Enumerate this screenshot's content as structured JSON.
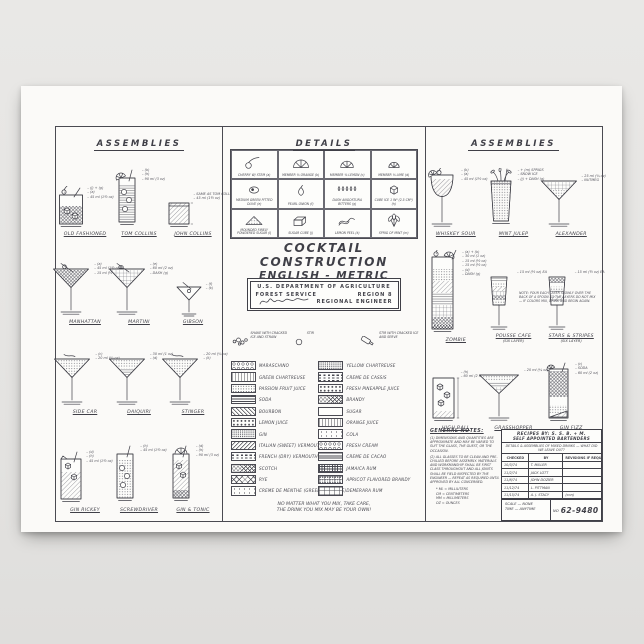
{
  "colors": {
    "page_background": "#e6e5e3",
    "paper": "#fbfaf8",
    "ink": "#3f3f47"
  },
  "sheet": {
    "left_panel": {
      "title": "ASSEMBLIES",
      "rows": [
        {
          "drinks": [
            {
              "name": "OLD FASHIONED",
              "glass": "rocks",
              "annotations": [
                "(j) + (g)",
                "(a)",
                "45 ml (1½ oz)"
              ]
            },
            {
              "name": "TOM COLLINS",
              "glass": "collins",
              "annotations": [
                "(b)",
                "(h)",
                "90 ml (3 oz)"
              ]
            },
            {
              "name": "JOHN COLLINS",
              "glass": "rocks_sq",
              "annotations": [
                "SAME AS TOM COLLINS",
                "45 ml (1½ oz)"
              ]
            }
          ]
        },
        {
          "drinks": [
            {
              "name": "MANHATTAN",
              "glass": "martini_cherry",
              "annotations": [
                "(a)",
                "45 ml (1½ oz)",
                "15 ml (½ oz)"
              ]
            },
            {
              "name": "MARTINI",
              "glass": "martini_olive",
              "annotations": [
                "(e)",
                "60 ml (2 oz)",
                "DASH (g)"
              ]
            },
            {
              "name": "GIBSON",
              "glass": "martini_sm",
              "annotations": [
                "(f)",
                "(k)"
              ]
            }
          ]
        },
        {
          "drinks": [
            {
              "name": "SIDE CAR",
              "glass": "martini_dots",
              "annotations": [
                "(c)",
                "20 ml (¾ oz)"
              ]
            },
            {
              "name": "DAIQUIRI",
              "glass": "martini_dots2",
              "annotations": [
                "30 ml (1 oz)",
                "(d)"
              ]
            },
            {
              "name": "STINGER",
              "glass": "martini_dots",
              "annotations": [
                "20 ml (¾ oz)",
                "(k)"
              ]
            }
          ]
        },
        {
          "drinks": [
            {
              "name": "GIN RICKEY",
              "glass": "rocks_tall",
              "annotations": [
                "(d)",
                "(h)",
                "45 ml (1½ oz)"
              ]
            },
            {
              "name": "SCREWDRIVER",
              "glass": "collins_ice",
              "annotations": [
                "(h)",
                "45 ml (1½ oz)"
              ]
            },
            {
              "name": "GIN & TONIC",
              "glass": "collins_garnish",
              "annotations": [
                "(d)",
                "(h)",
                "90 ml (3 oz)"
              ]
            }
          ]
        }
      ]
    },
    "center_panel": {
      "title": "DETAILS",
      "grid": [
        {
          "icon": "cherry",
          "label": "CHERRY W/ STEM (a)"
        },
        {
          "icon": "orange",
          "label": "MEMBER ⅛ ORANGE (b)"
        },
        {
          "icon": "lemon",
          "label": "MEMBER ⅛ LEMON (c)"
        },
        {
          "icon": "lime",
          "label": "MEMBER ⅛ LIME (d)"
        },
        {
          "icon": "olive",
          "label": "MEDIUM GREEN PITTED OLIVE (e)"
        },
        {
          "icon": "onion",
          "label": "PEARL ONION (f)"
        },
        {
          "icon": "bitters",
          "label": "DASH ANGOSTURA BITTERS (g)"
        },
        {
          "icon": "ice",
          "label": "CUBE ICE 1 IN³ (2.5 CM³) (h)"
        },
        {
          "icon": "sugar_mound",
          "label": "MOUNDED FINELY POWDERED SUGAR (i)"
        },
        {
          "icon": "sugar_cube",
          "label": "SUGAR CUBE (j)"
        },
        {
          "icon": "peel",
          "label": "LEMON PEEL (k)"
        },
        {
          "icon": "mint",
          "label": "SPRIG OF MINT (m)"
        }
      ],
      "main_title": {
        "line1": "COCKTAIL CONSTRUCTION",
        "line2": "ENGLISH - METRIC"
      },
      "stamp": {
        "line1": "U.S. DEPARTMENT OF AGRICULTURE",
        "line2_left": "FOREST SERVICE",
        "line2_right": "REGION 8",
        "line3": "REGIONAL ENGINEER"
      },
      "legend": {
        "keys": [
          {
            "icon": "shake",
            "label": "SHAKE WITH CRACKED ICE AND STRAIN"
          },
          {
            "icon": "stir",
            "label": "STIR"
          },
          {
            "icon": "pour",
            "label": "STIR WITH CRACKED ICE AND SERVE"
          }
        ],
        "left": [
          {
            "pattern": "rings",
            "label": "MARASCHINO"
          },
          {
            "pattern": "vdash",
            "label": "GREEN CHARTREUSE"
          },
          {
            "pattern": "dots",
            "label": "PASSION FRUIT JUICE"
          },
          {
            "pattern": "horiz",
            "label": "SODA"
          },
          {
            "pattern": "diag",
            "label": "BOURBON"
          },
          {
            "pattern": "dotlg",
            "label": "LEMON JUICE"
          },
          {
            "pattern": "dotsm",
            "label": "GIN"
          },
          {
            "pattern": "diag2",
            "label": "ITALIAN (SWEET) VERMOUTH"
          },
          {
            "pattern": "hdash",
            "label": "FRENCH (DRY) VERMOUTH"
          },
          {
            "pattern": "cross",
            "label": "SCOTCH"
          },
          {
            "pattern": "diamond",
            "label": "RYE"
          },
          {
            "pattern": "dotsp",
            "label": "CREME DE MENTHE (GREEN OR WHITE)"
          }
        ],
        "right": [
          {
            "pattern": "dotsm",
            "label": "YELLOW CHARTREUSE"
          },
          {
            "pattern": "hdash",
            "label": "CREME DE CASSIS"
          },
          {
            "pattern": "dotlg",
            "label": "FRESH PINEAPPLE JUICE"
          },
          {
            "pattern": "cross",
            "label": "BRANDY"
          },
          {
            "pattern": "blank",
            "label": "SUGAR"
          },
          {
            "pattern": "vdash",
            "label": "ORANGE JUICE"
          },
          {
            "pattern": "dotsp",
            "label": "COLA"
          },
          {
            "pattern": "rings",
            "label": "FRESH CREAM"
          },
          {
            "pattern": "hdense",
            "label": "CREME DE CACAO"
          },
          {
            "pattern": "gridh",
            "label": "JAMAICA RUM"
          },
          {
            "pattern": "brickdot",
            "label": "APRICOT FLAVORED BRANDY"
          },
          {
            "pattern": "brick",
            "label": "DEMERARA RUM"
          }
        ]
      },
      "footnote_line1": "NO MATTER WHAT YOU MIX, TAKE CARE,",
      "footnote_line2": "THE DRINK YOU MIX MAY BE YOUR OWN!"
    },
    "right_panel": {
      "title": "ASSEMBLIES",
      "rows": [
        {
          "drinks": [
            {
              "name": "WHISKEY SOUR",
              "glass": "sour",
              "annotations": [
                "(b)",
                "(a)",
                "45 ml (1½ oz)"
              ]
            },
            {
              "name": "MINT JULEP",
              "glass": "julep",
              "annotations": [
                "+ (m) SPRIGS",
                "SNOW ICE",
                "(j) + DASH (g)"
              ]
            },
            {
              "name": "ALEXANDER",
              "glass": "martini_alex",
              "annotations": [
                "25 ml (¾ oz)",
                "NUTMEG"
              ]
            }
          ]
        },
        {
          "drinks": [
            {
              "name": "ZOMBIE",
              "glass": "zombie",
              "annotations": [
                "(a) + (b)",
                "30 ml (1 oz)",
                "15 ml (½ oz)",
                "15 ml (½ oz)",
                "(d)",
                "DASH (g)"
              ]
            },
            {
              "name": "POUSSE CAFE",
              "sub": "(SIX LAYER)",
              "glass": "pousse",
              "annotations": [
                "15 ml (½ oz) EA"
              ]
            },
            {
              "name": "STARS & STRIPES",
              "sub": "(SIX LAYER)",
              "glass": "stars",
              "annotations": [
                "15 ml (½ oz) EA"
              ]
            }
          ]
        },
        {
          "drinks": [
            {
              "name": "HIGH BALL",
              "glass": "highball",
              "annotations": [
                "(h)",
                "60 ml (2 oz)"
              ]
            },
            {
              "name": "GRASSHOPPER",
              "glass": "grasshopper",
              "annotations": [
                "20 ml (¾ oz) EA"
              ]
            },
            {
              "name": "GIN FIZZ",
              "glass": "fizz",
              "annotations": [
                "(c)",
                "SODA",
                "60 ml (2 oz)"
              ]
            }
          ]
        }
      ],
      "note": "NOTE: POUR EACH LAYER SLOWLY OVER THE BACK OF A SPOON SO THE LAYERS DO NOT MIX — IF COLORS MIX, DRINK AND BEGIN AGAIN.",
      "general_notes": {
        "heading": "GENERAL NOTES:",
        "items": [
          "(1) DIMENSIONS AND QUANTITIES ARE APPROXIMATE AND MAY BE VARIED TO SUIT THE GLASS, THE GUEST, OR THE OCCASION.",
          "(2) ALL GLASSES TO BE CLEAN AND PRE-CHILLED BEFORE ASSEMBLY. MATERIALS AND WORKMANSHIP SHALL BE FIRST CLASS THROUGHOUT AND ALL JOINTS SHALL BE FIELD INSPECTED BY THE ENGINEER — REPEAT AS REQUIRED UNTIL APPROVED BY ALL CONCERNED."
        ],
        "footnotes": [
          "* ML ≈ MILLILITERS",
          "CM ≈ CENTIMETERS",
          "MM ≈ MILLIMETERS",
          "OZ ≈ OUNCES"
        ]
      },
      "title_block": {
        "line1": "RECIPES BY: S. S. B. + M.",
        "line2": "SELF APPOINTED BARTENDERS",
        "line3": "DETAILS & ASSEMBLIES OF MIXED DRINKS — WHAT DID WE LEAVE OUT?",
        "col_headers": [
          "CHECKED",
          "BY",
          "REVISIONS IF REQUIRED"
        ],
        "rows": [
          [
            "10/3/74",
            "T. MILLER",
            ""
          ],
          [
            "11/2/74",
            "JACK LOTT",
            ""
          ],
          [
            "11/8/74",
            "JOHN DOZIER",
            ""
          ],
          [
            "11/12/74",
            "L. PITTMAN",
            ""
          ],
          [
            "11/15/74",
            "A. J. STACY",
            "(con)"
          ]
        ],
        "scale": "SCALE — NONE",
        "time": "TIME — ANYTIME",
        "number_label": "NO",
        "number": "62-9480"
      }
    }
  }
}
